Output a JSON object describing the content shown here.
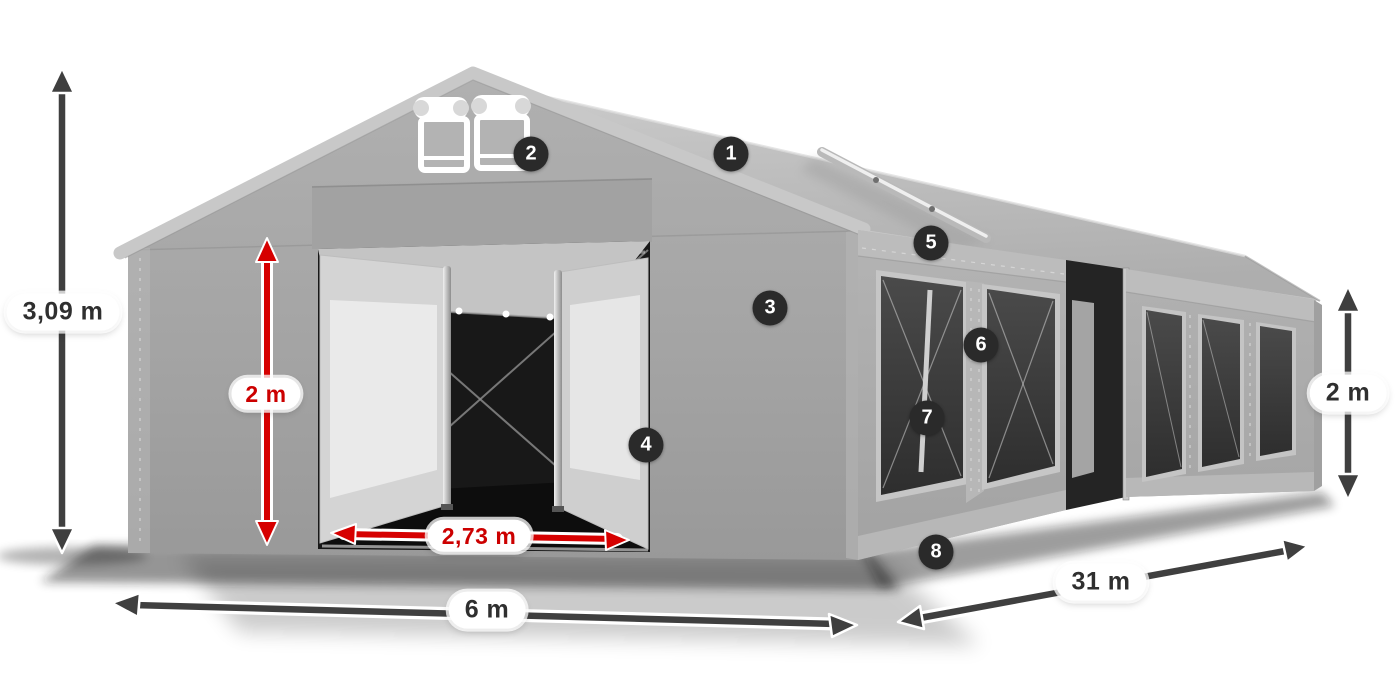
{
  "diagram": {
    "subject": "party-tent-dimension-diagram",
    "labels": {
      "total_height": "3,09 m",
      "entrance_height": "2 m",
      "entrance_width": "2,73 m",
      "tent_width": "6 m",
      "tent_length": "31 m",
      "side_height": "2 m"
    },
    "badges": [
      "1",
      "2",
      "3",
      "4",
      "5",
      "6",
      "7",
      "8"
    ],
    "colors": {
      "dimension_dark": "#3f3f3f",
      "dimension_red": "#d60000",
      "label_text_dark": "#2f2f2f",
      "label_text_red": "#cc0000",
      "badge_background": "#2a2a2a",
      "badge_text": "#ffffff",
      "tent_gray": "#a8a8a8",
      "background": "#ffffff"
    }
  }
}
